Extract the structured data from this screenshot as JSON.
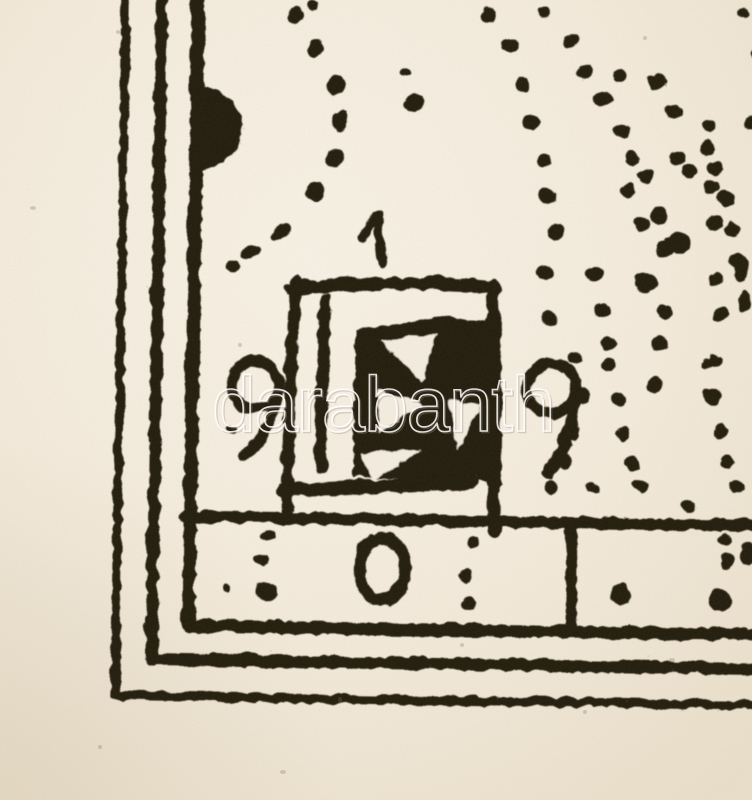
{
  "colors": {
    "paper": "#f5edе0",
    "paper_center": "#f8f1e5",
    "paper_edge": "#eadfca",
    "paper_fix": "#f5ede0",
    "ink": "#231a11",
    "speck": "#8a6f52",
    "watermark_stroke": "#ffffff",
    "watermark_shadow": "#9b9183"
  },
  "watermark": {
    "text": "darabanth",
    "opacity": 0.85,
    "font_size": 78,
    "x": 212,
    "y": 431
  },
  "print": {
    "rotation_deg": 0.9,
    "rotation_cx": 376,
    "rotation_cy": 400
  },
  "border": {
    "lines": [
      {
        "d": "M118,-12 L118,698 L770,698",
        "w": 9
      },
      {
        "d": "M154,-12 L154,661 L770,661",
        "w": 12
      },
      {
        "d": "M190,-12 L190,627 L770,627",
        "w": 13
      },
      {
        "d": "M186,518 L770,518",
        "w": 12
      },
      {
        "d": "M572,518 L572,627",
        "w": 11
      }
    ],
    "blob": "M192,86 C220,90 238,108 237,130 C236,153 215,168 192,172 L192,86 Z"
  },
  "tablet": {
    "strokes": [
      {
        "d": "M292,283 C289,350 287,430 288,518",
        "w": 12
      },
      {
        "d": "M287,289 C340,282 430,279 491,284",
        "w": 12
      },
      {
        "d": "M283,490 C340,487 415,483 474,479",
        "w": 13
      },
      {
        "d": "M490,282 C493,360 493,450 494,526",
        "w": 14
      },
      {
        "d": "M322,298 C320,355 319,420 321,467",
        "w": 12
      }
    ],
    "fill_shape": "M352,328 L438,314 L496,318 L496,477 L352,477 Z",
    "cutouts": [
      "M378,338 L436,332 L420,380 Z",
      "M376,387 L420,402 L377,430 Z",
      "M446,397 L479,402 L457,447 Z",
      "M361,452 L419,447 L372,479 Z"
    ]
  },
  "digits": [
    {
      "char": "1",
      "name": "digit-1",
      "strokes": [
        {
          "d": "M359,237 C363,228 368,219 373,214",
          "w": 9
        },
        {
          "d": "M373,214 C374,228 376,245 379,261",
          "w": 10
        }
      ]
    },
    {
      "char": "9",
      "name": "digit-9-left",
      "strokes": [
        {
          "d": "M272,370 C263,357 241,357 233,371 C226,384 231,401 244,407 C256,412 270,407 275,396 C279,387 277,377 272,370",
          "w": 11
        },
        {
          "d": "M276,391 C274,414 263,438 243,456",
          "w": 11
        }
      ]
    },
    {
      "char": "9",
      "name": "digit-9-right",
      "strokes": [
        {
          "d": "M570,370 C561,356 537,356 528,371 C521,384 526,401 539,407 C551,412 566,407 571,396 C575,387 574,377 570,370",
          "w": 11
        },
        {
          "d": "M573,391 C572,418 564,447 548,468",
          "w": 12
        }
      ]
    },
    {
      "char": "0",
      "name": "digit-0",
      "strokes": [
        {
          "d": "M379,536 C365,541 357,559 361,577 C364,594 377,602 390,597 C403,592 409,572 404,555 C400,541 390,533 379,536",
          "w": 12
        }
      ]
    }
  ],
  "dots": [
    [
      305,
      4,
      6,
      5,
      0
    ],
    [
      288,
      15,
      7,
      8,
      0
    ],
    [
      309,
      47,
      8,
      9,
      0
    ],
    [
      330,
      84,
      9,
      9,
      0
    ],
    [
      334,
      120,
      9,
      10,
      0
    ],
    [
      329,
      157,
      9,
      9,
      0
    ],
    [
      311,
      191,
      10,
      9,
      0
    ],
    [
      276,
      232,
      12,
      6,
      -35
    ],
    [
      247,
      252,
      11,
      6,
      -25
    ],
    [
      228,
      266,
      7,
      6,
      -15
    ],
    [
      398,
      70,
      6,
      5,
      0
    ],
    [
      407,
      101,
      10,
      9,
      0
    ],
    [
      481,
      11,
      8,
      7,
      0
    ],
    [
      502,
      43,
      9,
      8,
      0
    ],
    [
      517,
      80,
      8,
      8,
      0
    ],
    [
      536,
      8,
      7,
      6,
      0
    ],
    [
      563,
      36,
      8,
      7,
      0
    ],
    [
      578,
      67,
      8,
      8,
      0
    ],
    [
      613,
      70,
      7,
      6,
      0
    ],
    [
      650,
      76,
      10,
      8,
      0
    ],
    [
      597,
      93,
      9,
      8,
      0
    ],
    [
      668,
      105,
      8,
      7,
      0
    ],
    [
      703,
      119,
      8,
      7,
      0
    ],
    [
      746,
      116,
      7,
      7,
      0
    ],
    [
      616,
      125,
      8,
      7,
      0
    ],
    [
      627,
      152,
      8,
      7,
      0
    ],
    [
      671,
      151,
      8,
      7,
      0
    ],
    [
      702,
      141,
      8,
      7,
      0
    ],
    [
      710,
      161,
      7,
      7,
      0
    ],
    [
      721,
      191,
      8,
      8,
      0
    ],
    [
      727,
      223,
      8,
      8,
      0
    ],
    [
      733,
      253,
      8,
      7,
      0
    ],
    [
      623,
      185,
      8,
      7,
      0
    ],
    [
      637,
      218,
      8,
      7,
      0
    ],
    [
      661,
      243,
      9,
      8,
      0
    ],
    [
      640,
      170,
      8,
      7,
      0
    ],
    [
      735,
      5,
      6,
      5,
      0
    ],
    [
      750,
      48,
      5,
      7,
      0
    ],
    [
      525,
      118,
      8,
      8,
      0
    ],
    [
      539,
      156,
      8,
      8,
      0
    ],
    [
      543,
      192,
      8,
      9,
      0
    ],
    [
      551,
      227,
      8,
      9,
      0
    ],
    [
      540,
      268,
      9,
      7,
      20
    ],
    [
      591,
      268,
      9,
      7,
      0
    ],
    [
      546,
      314,
      8,
      7,
      30
    ],
    [
      599,
      304,
      8,
      7,
      0
    ],
    [
      606,
      338,
      8,
      7,
      0
    ],
    [
      642,
      276,
      12,
      10,
      0
    ],
    [
      655,
      210,
      9,
      8,
      0
    ],
    [
      673,
      237,
      12,
      10,
      0
    ],
    [
      683,
      164,
      8,
      7,
      0
    ],
    [
      707,
      180,
      8,
      7,
      0
    ],
    [
      710,
      216,
      8,
      7,
      0
    ],
    [
      712,
      272,
      7,
      7,
      0
    ],
    [
      717,
      308,
      8,
      7,
      0
    ],
    [
      658,
      338,
      8,
      7,
      0
    ],
    [
      661,
      305,
      8,
      7,
      0
    ],
    [
      713,
      355,
      8,
      7,
      0
    ],
    [
      653,
      380,
      8,
      8,
      0
    ],
    [
      710,
      390,
      8,
      7,
      0
    ],
    [
      737,
      262,
      7,
      12,
      10
    ],
    [
      741,
      295,
      6,
      10,
      5
    ],
    [
      572,
      353,
      7,
      6,
      0
    ],
    [
      580,
      391,
      7,
      7,
      0
    ],
    [
      572,
      428,
      7,
      8,
      0
    ],
    [
      563,
      458,
      7,
      8,
      0
    ],
    [
      550,
      482,
      7,
      7,
      0
    ],
    [
      606,
      360,
      7,
      6,
      0
    ],
    [
      616,
      394,
      7,
      7,
      0
    ],
    [
      622,
      428,
      7,
      8,
      0
    ],
    [
      632,
      458,
      7,
      7,
      0
    ],
    [
      642,
      480,
      7,
      6,
      0
    ],
    [
      706,
      357,
      7,
      6,
      0
    ],
    [
      712,
      391,
      7,
      7,
      0
    ],
    [
      719,
      424,
      7,
      7,
      0
    ],
    [
      726,
      454,
      7,
      7,
      0
    ],
    [
      736,
      479,
      8,
      6,
      0
    ],
    [
      592,
      483,
      7,
      5,
      0
    ],
    [
      639,
      478,
      8,
      5,
      0
    ],
    [
      688,
      500,
      7,
      5,
      0
    ],
    [
      268,
      536,
      7,
      7,
      0
    ],
    [
      262,
      560,
      7,
      6,
      0
    ],
    [
      268,
      591,
      11,
      9,
      0
    ],
    [
      227,
      589,
      4,
      4,
      0
    ],
    [
      230,
      430,
      5,
      4,
      0
    ],
    [
      473,
      538,
      6,
      6,
      0
    ],
    [
      467,
      573,
      7,
      6,
      0
    ],
    [
      470,
      600,
      8,
      7,
      0
    ],
    [
      622,
      588,
      10,
      11,
      0
    ],
    [
      724,
      533,
      7,
      7,
      0
    ],
    [
      728,
      554,
      7,
      7,
      0
    ],
    [
      721,
      592,
      12,
      11,
      0
    ],
    [
      748,
      545,
      7,
      12,
      0
    ]
  ],
  "specks": [
    [
      33,
      208,
      3,
      2
    ],
    [
      118,
      32,
      2,
      2
    ],
    [
      462,
      645,
      2,
      2
    ],
    [
      283,
      772,
      3,
      2
    ],
    [
      672,
      660,
      3,
      2
    ],
    [
      100,
      747,
      2,
      2
    ],
    [
      645,
      38,
      2,
      2
    ],
    [
      340,
      700,
      2,
      3
    ],
    [
      585,
      712,
      2,
      2
    ],
    [
      240,
      345,
      2,
      2
    ]
  ]
}
